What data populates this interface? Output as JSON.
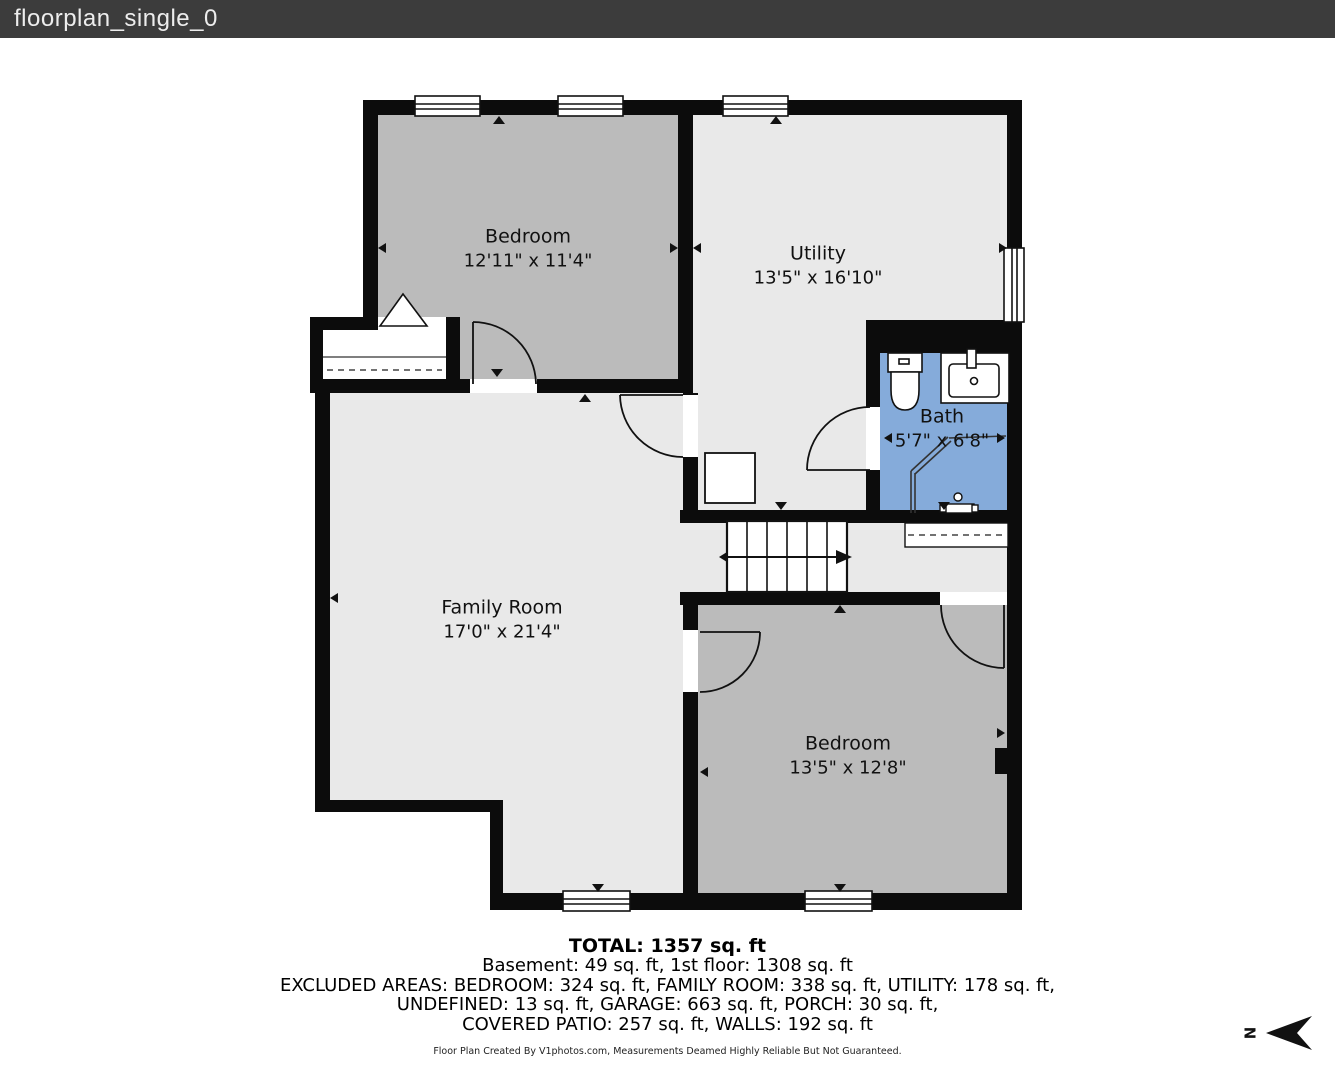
{
  "header": {
    "title": "floorplan_single_0"
  },
  "plan": {
    "rooms": {
      "bedroom1": {
        "name": "Bedroom",
        "dims": "12'11\" x 11'4\""
      },
      "utility": {
        "name": "Utility",
        "dims": "13'5\" x 16'10\""
      },
      "bath": {
        "name": "Bath",
        "dims": "5'7\" x 6'8\""
      },
      "family_room": {
        "name": "Family Room",
        "dims": "17'0\" x 21'4\""
      },
      "bedroom2": {
        "name": "Bedroom",
        "dims": "13'5\" x 12'8\""
      }
    },
    "compass": {
      "label": "N"
    }
  },
  "summary": {
    "total": "TOTAL: 1357 sq. ft",
    "floors": "Basement: 49 sq. ft, 1st floor: 1308 sq. ft",
    "excluded_line1": "EXCLUDED AREAS: BEDROOM: 324 sq. ft, FAMILY ROOM: 338 sq. ft, UTILITY: 178 sq. ft,",
    "excluded_line2": "UNDEFINED: 13 sq. ft, GARAGE: 663 sq. ft, PORCH: 30 sq. ft,",
    "excluded_line3": "COVERED PATIO: 257 sq. ft, WALLS: 192 sq. ft"
  },
  "credit": "Floor Plan Created By V1photos.com, Measurements Deamed Highly Reliable But Not Guaranteed.",
  "colors": {
    "header_bg": "#3c3c3c",
    "wall": "#0c0c0c",
    "room_gray": "#bbbbbb",
    "room_light": "#e9e9e9",
    "bath_blue": "#85abda"
  }
}
